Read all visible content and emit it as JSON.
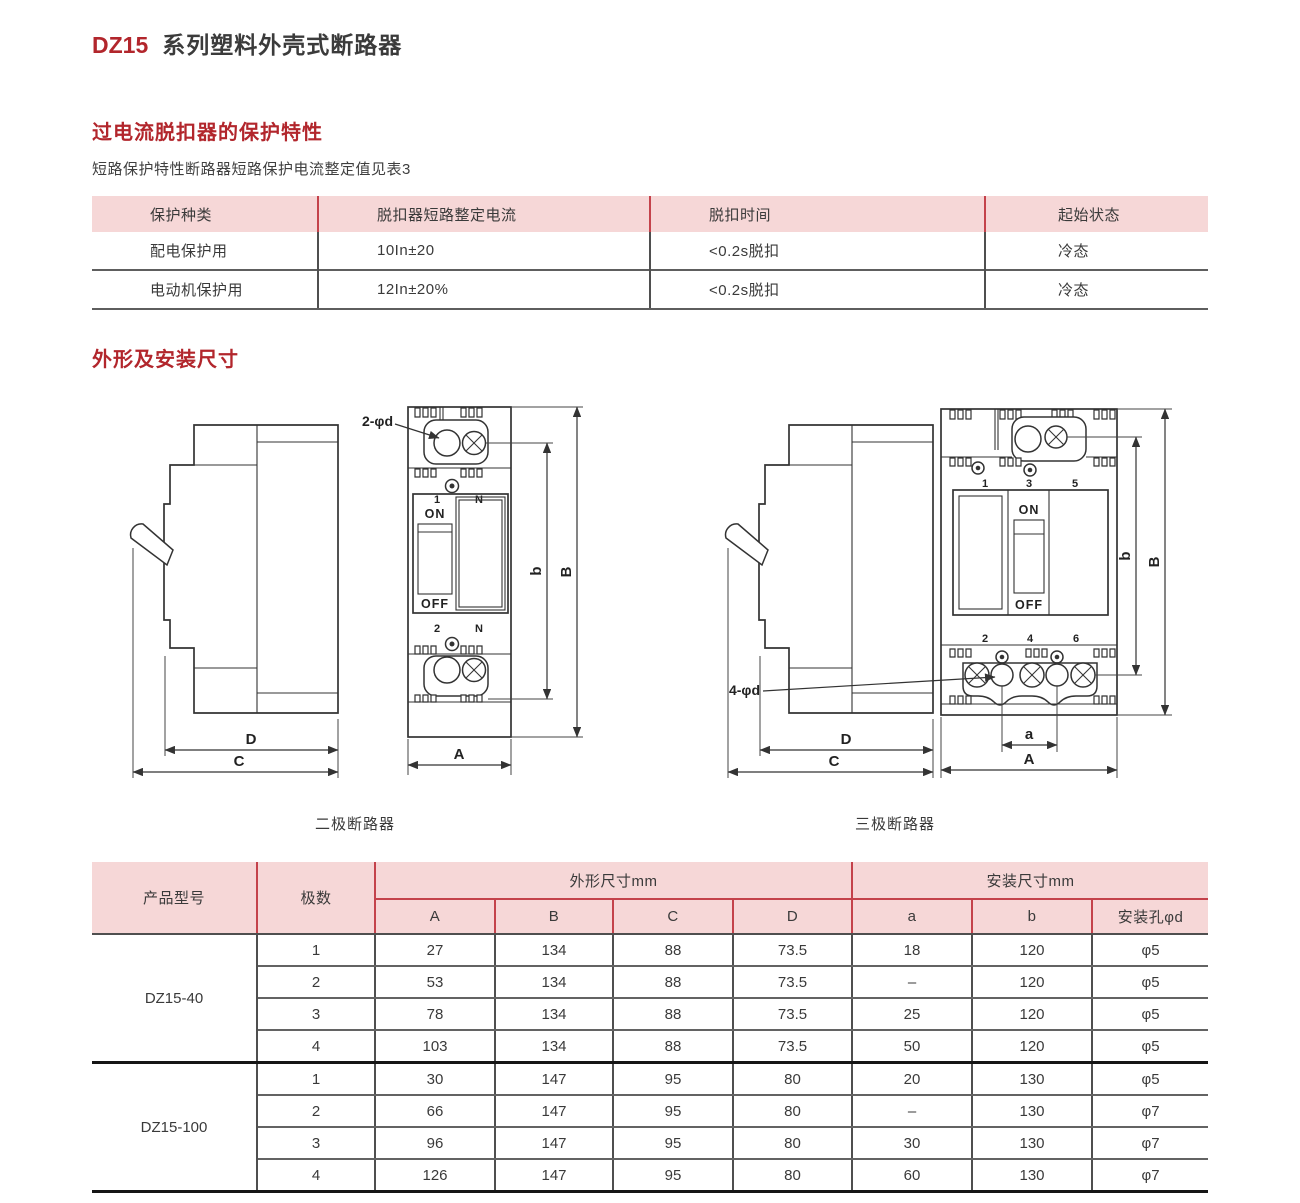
{
  "page": {
    "title_model": "DZ15",
    "title_rest": "系列塑料外壳式断路器"
  },
  "sections": {
    "protection_heading": "过电流脱扣器的保护特性",
    "protection_note": "短路保护特性断路器短路保护电流整定值见表3",
    "dimensions_heading": "外形及安装尺寸"
  },
  "protection_table": {
    "headers": [
      "保护种类",
      "脱扣器短路整定电流",
      "脱扣时间",
      "起始状态"
    ],
    "rows": [
      [
        "配电保护用",
        "10In±20",
        "<0.2s脱扣",
        "冷态"
      ],
      [
        "电动机保护用",
        "12In±20%",
        "<0.2s脱扣",
        "冷态"
      ]
    ]
  },
  "drawings": {
    "left_caption": "二极断路器",
    "right_caption": "三极断路器",
    "left": {
      "hole_label": "2-φd",
      "on": "ON",
      "off": "OFF",
      "top_terminals": [
        "1",
        "N"
      ],
      "bottom_terminals": [
        "2",
        "N"
      ],
      "dims": {
        "A": "A",
        "B": "B",
        "C": "C",
        "D": "D",
        "b": "b"
      }
    },
    "right": {
      "hole_label": "4-φd",
      "on": "ON",
      "off": "OFF",
      "top_terminals": [
        "1",
        "3",
        "5"
      ],
      "bottom_terminals": [
        "2",
        "4",
        "6"
      ],
      "dims": {
        "A": "A",
        "B": "B",
        "C": "C",
        "D": "D",
        "a": "a",
        "b": "b"
      }
    }
  },
  "dimensions_table": {
    "product_header": "产品型号",
    "poles_header": "极数",
    "outline_group": "外形尺寸mm",
    "mounting_group": "安装尺寸mm",
    "sub_headers": [
      "A",
      "B",
      "C",
      "D",
      "a",
      "b",
      "安装孔φd"
    ],
    "groups": [
      {
        "model": "DZ15-40",
        "rows": [
          [
            "1",
            "27",
            "134",
            "88",
            "73.5",
            "18",
            "120",
            "φ5"
          ],
          [
            "2",
            "53",
            "134",
            "88",
            "73.5",
            "–",
            "120",
            "φ5"
          ],
          [
            "3",
            "78",
            "134",
            "88",
            "73.5",
            "25",
            "120",
            "φ5"
          ],
          [
            "4",
            "103",
            "134",
            "88",
            "73.5",
            "50",
            "120",
            "φ5"
          ]
        ]
      },
      {
        "model": "DZ15-100",
        "rows": [
          [
            "1",
            "30",
            "147",
            "95",
            "80",
            "20",
            "130",
            "φ5"
          ],
          [
            "2",
            "66",
            "147",
            "95",
            "80",
            "–",
            "130",
            "φ7"
          ],
          [
            "3",
            "96",
            "147",
            "95",
            "80",
            "30",
            "130",
            "φ7"
          ],
          [
            "4",
            "126",
            "147",
            "95",
            "80",
            "60",
            "130",
            "φ7"
          ]
        ]
      }
    ]
  },
  "colors": {
    "accent_red": "#b2262c",
    "table_line_red": "#c4424b",
    "header_pink": "#f6d7d7",
    "line_dark": "#4f4f4f"
  }
}
